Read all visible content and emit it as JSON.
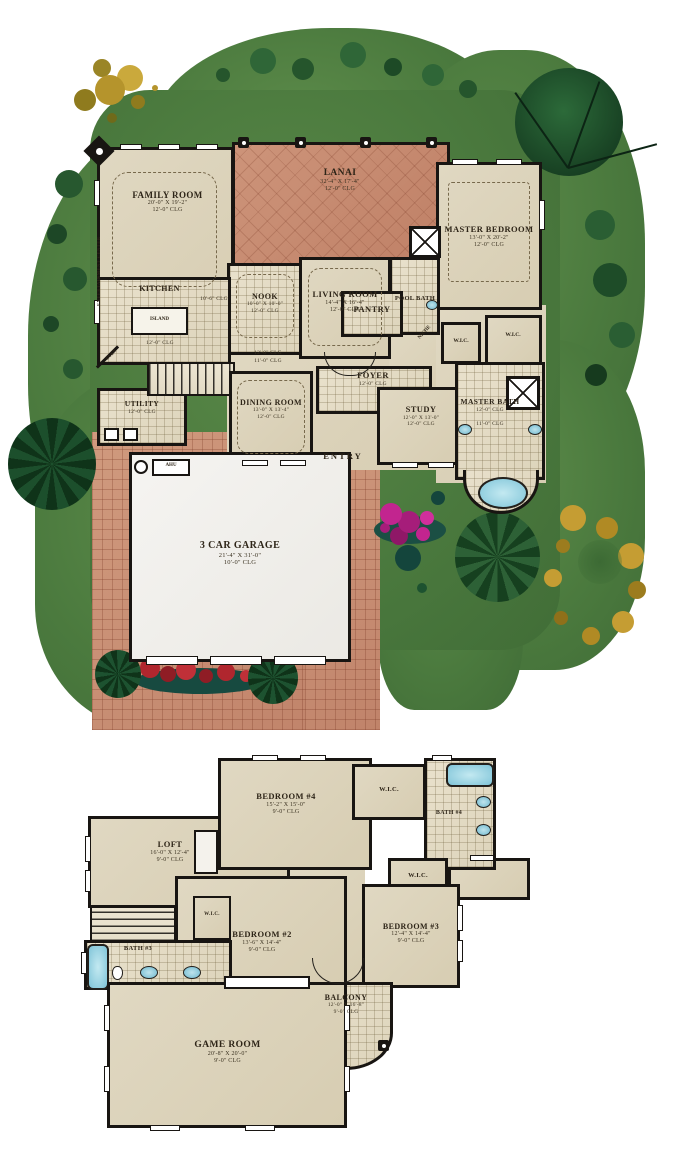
{
  "floor1": {
    "rooms": {
      "family": {
        "name": "FAMILY ROOM",
        "dims": "20'-0\" X 19'-2\"",
        "clg": "12'-0\" CLG"
      },
      "lanai": {
        "name": "LANAI",
        "dims": "32'-4\" X 17'-4\"",
        "clg": "12'-0\" CLG"
      },
      "master_bedroom": {
        "name": "MASTER BEDROOM",
        "dims": "13'-0\" X 20'-2\"",
        "clg": "12'-0\" CLG"
      },
      "nook": {
        "name": "NOOK",
        "dims": "10'-0\" X 10'-0\"",
        "clg": "12'-0\" CLG"
      },
      "living": {
        "name": "LIVING ROOM",
        "dims": "14'-4\" X 16'-4\"",
        "clg": "12'-0\" CLG"
      },
      "pool_bath": {
        "name": "POOL BATH"
      },
      "kitchen": {
        "name": "KITCHEN",
        "island": "ISLAND",
        "clg": "12'-0\" CLG",
        "clg_soffit": "10'-6\" CLG"
      },
      "pantry": {
        "name": "PANTRY"
      },
      "oven": {
        "name": "OVEN"
      },
      "utility": {
        "name": "UTILITY",
        "clg": "12'-0\" CLG"
      },
      "dining": {
        "name": "DINING ROOM",
        "dims": "13'-0\" X 13'-4\"",
        "clg": "12'-0\" CLG",
        "clg_upper": "12'-0\" CLG",
        "clg_lower": "11'-0\" CLG"
      },
      "foyer": {
        "name": "FOYER",
        "clg": "12'-0\" CLG"
      },
      "study": {
        "name": "STUDY",
        "dims": "12'-0\" X 13'-0\"",
        "clg": "12'-0\" CLG"
      },
      "niche": {
        "name": "NICHE"
      },
      "wic_left": {
        "name": "W.I.C."
      },
      "wic_right": {
        "name": "W.I.C."
      },
      "master_bath": {
        "name": "MASTER BATH",
        "clg": "12'-0\" CLG",
        "clg2": "11'-0\" CLG"
      },
      "entry": {
        "name": "ENTRY"
      },
      "garage": {
        "name": "3 CAR GARAGE",
        "dims": "21'-4\" X 31'-0\"",
        "clg": "10'-0\" CLG"
      },
      "ahu": {
        "name": "AHU"
      },
      "entertainment_center": {
        "name": "ENTERTAINMENT CENTER"
      }
    }
  },
  "floor2": {
    "rooms": {
      "bedroom4": {
        "name": "BEDROOM #4",
        "dims": "15'-2\" X 15'-0\"",
        "clg": "9'-0\" CLG"
      },
      "wic_b4": {
        "name": "W.I.C."
      },
      "bath4": {
        "name": "BATH #4"
      },
      "loft": {
        "name": "LOFT",
        "dims": "16'-0\" X 12'-4\"",
        "clg": "9'-0\" CLG"
      },
      "wic_b2": {
        "name": "W.I.C."
      },
      "bedroom2": {
        "name": "BEDROOM #2",
        "dims": "13'-6\" X 14'-4\"",
        "clg": "9'-0\" CLG"
      },
      "wic_b3": {
        "name": "W.I.C."
      },
      "bedroom3": {
        "name": "BEDROOM #3",
        "dims": "12'-4\" X 14'-4\"",
        "clg": "9'-0\" CLG"
      },
      "bath3": {
        "name": "BATH #3"
      },
      "balcony": {
        "name": "BALCONY",
        "dims": "12'-0\" X 16'-8\"",
        "clg": "9'-0\" CLG"
      },
      "game": {
        "name": "GAME ROOM",
        "dims": "20'-8\" X 20'-0\"",
        "clg": "9'-0\" CLG"
      }
    }
  },
  "colors": {
    "lawn": "#4b7a3e",
    "paver": "#c98f74",
    "room_fill": "#ddd4bc",
    "wall": "#181512",
    "water": "#7fc4d8",
    "flower_magenta": "#c2258f",
    "flower_red": "#b0262e",
    "autumn_gold": "#b5942c"
  }
}
